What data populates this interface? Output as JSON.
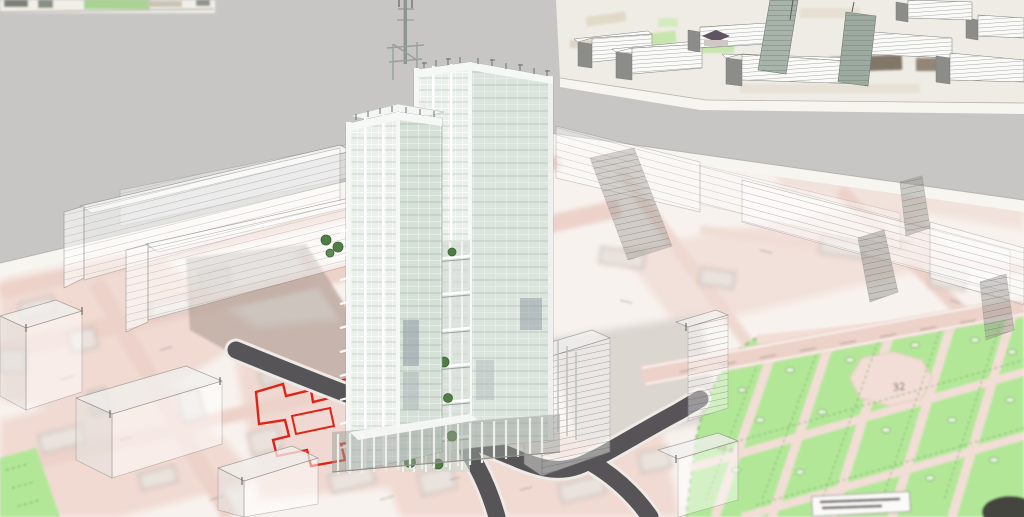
{
  "app": {
    "type": "3d-architectural-model-viewport",
    "description": "Aerial 3D massing study: twin glass high-rise tower with rooftop mast on a scanned cadastral site plan, translucent context slab buildings, dark access roads, red site-boundary outline, green public park, and a distant city-block model in the upper right"
  },
  "colors": {
    "bg": "#c7c6c4",
    "map_base": "#f8f2ee",
    "map_pink": "#f0dad2",
    "map_pink_deep": "#ecd2c9",
    "map_line": "#a39c96",
    "white_band": "#f7f5f0",
    "edge_line": "#b7b3ae",
    "park_green": "#b2e798",
    "park_path": "#f2ded6",
    "park_line": "#7fae6d",
    "road_dark": "#575457",
    "road_curb": "#eeeae5",
    "boundary_red": "#de2417",
    "slab_fill": "#ffffff",
    "slab_edge": "#8e8c89",
    "slab_dark": "#96948f",
    "shadow": "#85796f",
    "tower_glass_light": "#eaf0ea",
    "tower_glass_shade": "#dce5dd",
    "tower_white": "#f6f8f5",
    "tower_frame": "#ffffff",
    "tower_line": "#94a096",
    "tower_dark_panel": "#8c98a0",
    "tree_green": "#4f7d45",
    "tree_dark": "#3b6233",
    "mast_gray": "#8f948f",
    "island_ground": "#efece6",
    "island_face": "#fafaf8",
    "island_side": "#8c8c88",
    "island_stripe": "#8f8f8b",
    "island_green": "#c7e6ae",
    "island_brown": "#6f6052",
    "island_tower": "#a8b3a9",
    "island_roof": "#5f5560"
  },
  "map_labels": {
    "plaza_number": "32",
    "parcel_number": "48-4"
  },
  "scene": {
    "elements": [
      "twin-glass-tower",
      "rooftop-mast",
      "atrium-terrace-trees",
      "site-boundary-red-outline",
      "asphalt-access-roads",
      "translucent-context-slabs",
      "massing-boxes",
      "public-park",
      "cadastral-base-map",
      "distant-city-block-model",
      "tower-shadow"
    ]
  }
}
